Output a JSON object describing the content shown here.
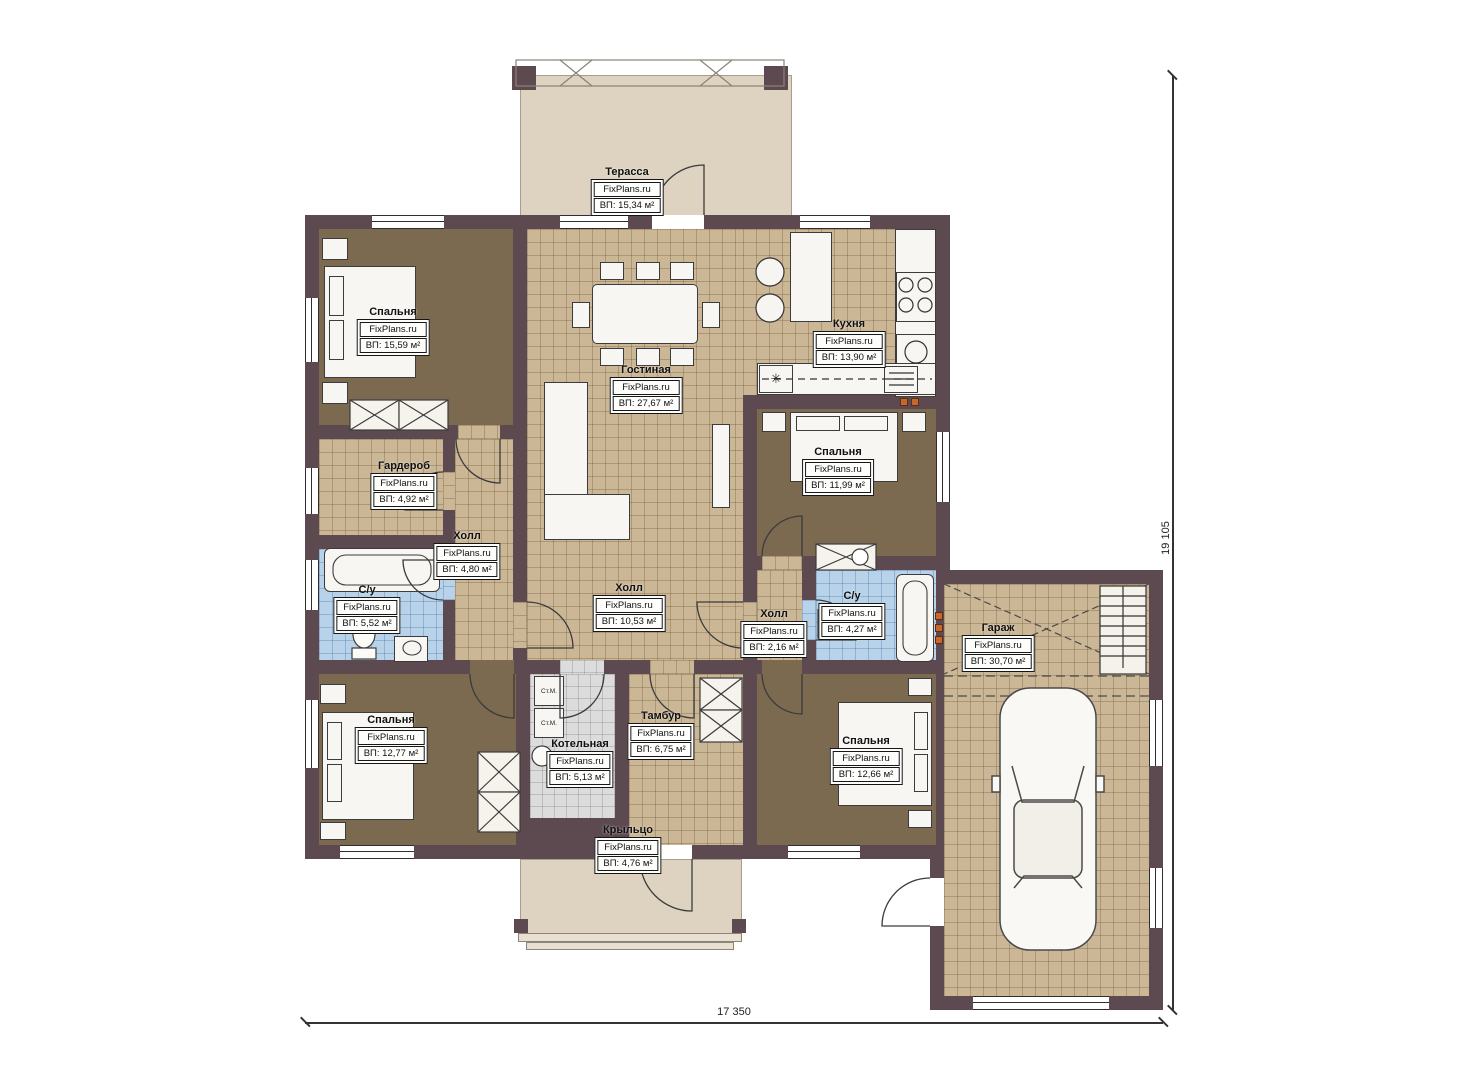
{
  "plan": {
    "brand_label": "FixPlans.ru",
    "rooms": {
      "terrace": {
        "name": "Терасса",
        "area": "ВП: 15,34 м²"
      },
      "bedroom_top_left": {
        "name": "Спальня",
        "area": "ВП: 15,59 м²"
      },
      "kitchen": {
        "name": "Кухня",
        "area": "ВП: 13,90 м²"
      },
      "living_room": {
        "name": "Гостиная",
        "area": "ВП: 27,67 м²"
      },
      "bedroom_right": {
        "name": "Спальня",
        "area": "ВП: 11,99 м²"
      },
      "wardrobe": {
        "name": "Гардероб",
        "area": "ВП: 4,92 м²"
      },
      "hall_left": {
        "name": "Холл",
        "area": "ВП: 4,80 м²"
      },
      "bathroom_left": {
        "name": "С/у",
        "area": "ВП: 5,52 м²"
      },
      "hall_center": {
        "name": "Холл",
        "area": "ВП: 10,53 м²"
      },
      "hall_right": {
        "name": "Холл",
        "area": "ВП: 2,16 м²"
      },
      "bathroom_right": {
        "name": "С/у",
        "area": "ВП: 4,27 м²"
      },
      "garage": {
        "name": "Гараж",
        "area": "ВП: 30,70 м²"
      },
      "bedroom_bottom_left": {
        "name": "Спальня",
        "area": "ВП: 12,77 м²"
      },
      "boiler_room": {
        "name": "Котельная",
        "area": "ВП: 5,13 м²"
      },
      "vestibule": {
        "name": "Тамбур",
        "area": "ВП: 6,75 м²"
      },
      "bedroom_bottom_center": {
        "name": "Спальня",
        "area": "ВП: 12,66 м²"
      },
      "porch": {
        "name": "Крыльцо",
        "area": "ВП: 4,76 м²"
      }
    },
    "annotations": {
      "washing_machine": "Ст.М.",
      "fridge_symbol": "✳"
    },
    "dimensions": {
      "width": "17 350",
      "height": "19 105"
    },
    "colors": {
      "wall": "#5d4a50",
      "tile_floor": "#cbb795",
      "carpet_floor": "#7b6950",
      "bathroom_floor": "#b8d3e9",
      "boiler_floor": "#dcdcdc",
      "outdoor_floor": "#ded3c0",
      "vent_orange": "#c9662e"
    }
  }
}
